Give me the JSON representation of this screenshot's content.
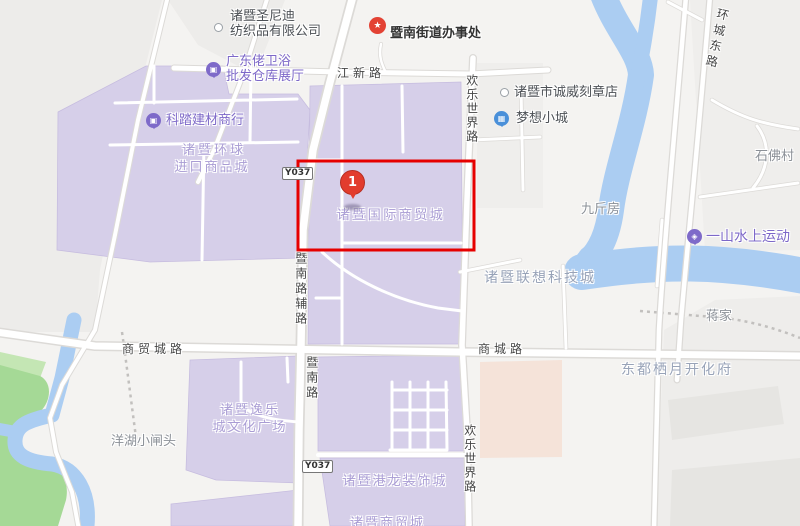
{
  "marker": {
    "number": "1"
  },
  "roads": {
    "jiangxin": "江新路",
    "huancheng_east": "环城东路",
    "huanle_world_top": "欢乐世界路",
    "huanle_world_bottom": "欢乐世界路",
    "jinan_aux": "暨南路辅路",
    "jinan": "暨南路",
    "shangmaocheng": "商贸城路",
    "shangcheng": "商城路",
    "y037_top": "Y037",
    "y037_bottom": "Y037"
  },
  "pois": {
    "shengnidi_line1": "诸暨圣尼迪",
    "shengnidi_line2": "纺织品有限公司",
    "jinan_office": "暨南街道办事处",
    "guangdonglao_line1": "广东佬卫浴",
    "guangdonglao_line2": "批发仓库展厅",
    "keta": "科踏建材商行",
    "chengwei": "诸暨市诚威刻章店",
    "dream_town": "梦想小城",
    "shifo_village": "石佛村",
    "jiujinfang": "九斤房",
    "yishan_water_sports": "一山水上运动",
    "lianxiang_tech": "诸暨联想科技城",
    "jiangjia": "蒋家",
    "dongdu_qiyue": "东都栖月开化府",
    "yanghu": "洋湖小闸头"
  },
  "areas": {
    "global_line1": "诸暨环球",
    "global_line2": "进口商品城",
    "intl_trade_city": "诸暨国际商贸城",
    "yile_line1": "诸暨逸乐",
    "yile_line2": "城文化广场",
    "ganglong": "诸暨港龙装饰城",
    "bottom_clipped": "诸暨商贸城"
  },
  "icons": {
    "office_star": "★",
    "shop_glyph": "▣",
    "town_glyph": "▦",
    "sports_glyph": "◈"
  },
  "colors": {
    "highlight_red": "#e60000",
    "marker_red": "#e23c2d",
    "block_purple": "#d6cfe9",
    "water_blue": "#abcdf2",
    "park_green": "#a5d996",
    "salmon_block": "#f5e3d9",
    "poi_purple": "#7d68c8"
  }
}
